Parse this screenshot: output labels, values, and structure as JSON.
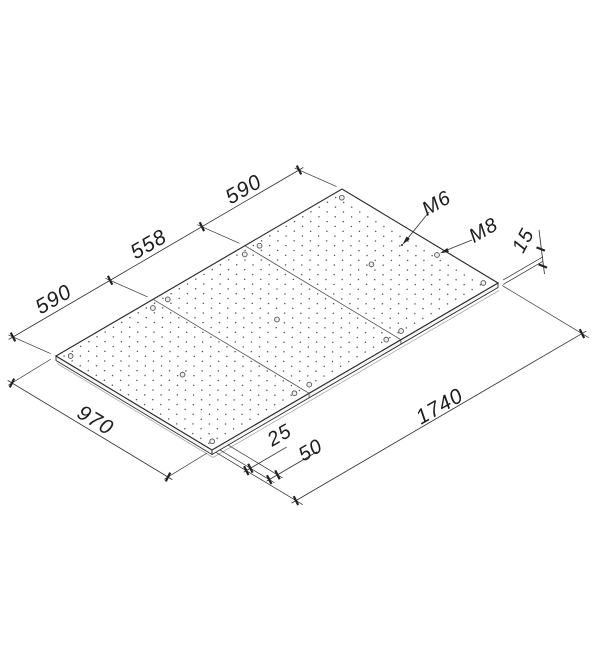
{
  "colors": {
    "background": "#ffffff",
    "line": "#2b2b2b",
    "dimension_line": "#333333",
    "hole_dot": "#555555",
    "text": "#1c1c1c"
  },
  "drawing": {
    "labels": {
      "segment_left": "590",
      "segment_middle": "558",
      "segment_right": "590",
      "thread_small": "M6",
      "thread_large": "M8",
      "thickness": "15",
      "width": "970",
      "length": "1740",
      "edge_offset": "25",
      "hole_pitch": "50"
    },
    "dimensions_mm": {
      "segments": [
        590,
        558,
        590
      ],
      "width": 970,
      "length": 1740,
      "thickness": 15,
      "edge_offset": 25,
      "hole_pitch": 50
    },
    "threads": {
      "grid_holes": "M6",
      "mount_holes": "M8"
    }
  }
}
